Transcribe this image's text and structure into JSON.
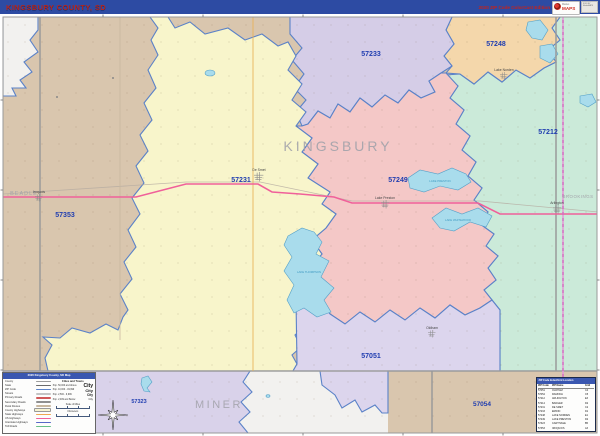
{
  "header": {
    "title": "KINGSBURY COUNTY, SD",
    "edition": "2020 ZIP Code ColorCast Edition",
    "logo_top": "Market",
    "logo_brand": "MAPS",
    "logo_side": "SOLD BY MarketMAPS"
  },
  "map": {
    "county_labels": {
      "kingsbury": "KINGSBURY",
      "beadle": "BEADLE",
      "miner": "MINER",
      "brookings": "BROOKINGS"
    },
    "zip_labels": {
      "z57353": "57353",
      "z57231": "57231",
      "z57233": "57233",
      "z57248": "57248",
      "z57212": "57212",
      "z57249": "57249",
      "z57051": "57051",
      "z57323": "57323",
      "z57054": "57054"
    },
    "cities": {
      "de_smet": "De Smet",
      "lake_preston": "Lake Preston",
      "arlington": "Arlington",
      "lake_norden": "Lake Norden",
      "iroquois": "Iroquois",
      "oldham": "Oldham"
    },
    "lakes": {
      "thompson": "LAKE THOMPSON",
      "preston": "LAKE PRESTON",
      "whitewood": "LAKE WHITEWOOD"
    },
    "colors": {
      "zip_boundary": "#5b82c8",
      "county_boundary": "#9b9b9b",
      "zip_label": "#1f3db0",
      "us_highway_14": "#f0609a",
      "us_highway_81": "#d76fc3",
      "lake_fill": "#a9dcec"
    }
  },
  "legend": {
    "title": "2020 Kingsbury County, SD Map",
    "road_items": [
      "County",
      "State",
      "ZIP Code",
      "Streets",
      "Primary Roads",
      "Secondary Roads",
      "Rural Routes",
      "County Highways",
      "State Highways",
      "US Highways",
      "Interstate Highways",
      "Toll Roads"
    ],
    "cities_header": "Cities and Towns",
    "city_rows": [
      {
        "label": "Pop. 50,000 and Above",
        "sample": "City"
      },
      {
        "label": "Pop. 10,000 - 49,999",
        "sample": "City"
      },
      {
        "label": "Pop. 2,500 - 9,999",
        "sample": "City"
      },
      {
        "label": "Pop. 2,499 and Below",
        "sample": "City"
      }
    ],
    "scale_miles": "Scale of Miles",
    "scale_km": "Kilometers"
  },
  "zip_table": {
    "title": "ZIP Code Index/Grid Location",
    "columns": [
      "ZIP Code",
      "ZIP Name",
      "Grid"
    ],
    "rows": [
      [
        "57051",
        "OLDHAM",
        "C4"
      ],
      [
        "57054",
        "RAMONA",
        "C5"
      ],
      [
        "57212",
        "ARLINGTON",
        "E3"
      ],
      [
        "57214",
        "BADGER",
        "D2"
      ],
      [
        "57231",
        "DE SMET",
        "C2"
      ],
      [
        "57233",
        "ERWIN",
        "D1"
      ],
      [
        "57248",
        "LAKE NORDEN",
        "E1"
      ],
      [
        "57249",
        "LAKE PRESTON",
        "D2"
      ],
      [
        "57323",
        "CARTHAGE",
        "B5"
      ],
      [
        "57353",
        "IROQUOIS",
        "A3"
      ]
    ]
  }
}
